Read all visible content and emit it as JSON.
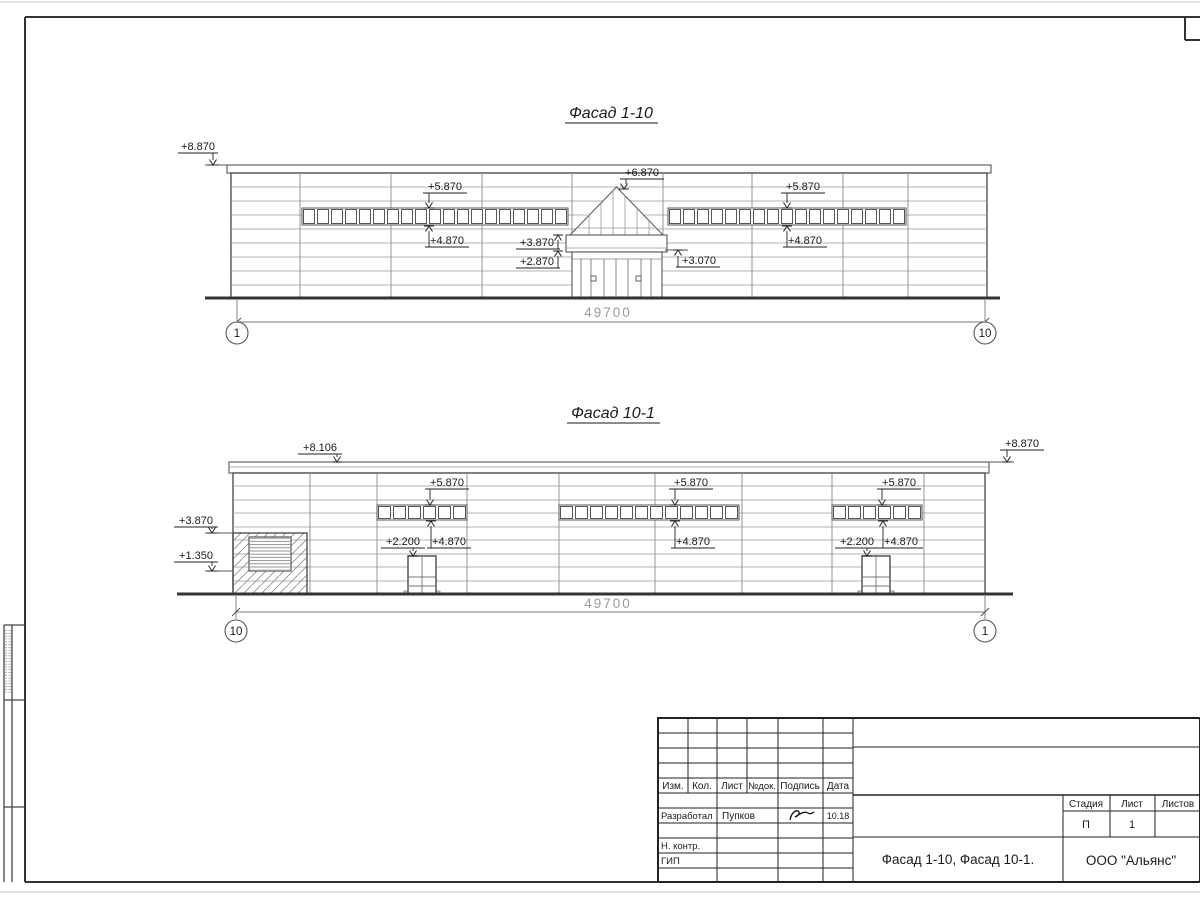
{
  "facades": {
    "top": {
      "title": "Фасад 1-10",
      "dimension": "49700",
      "axis_left": "1",
      "axis_right": "10",
      "marks": {
        "roof_left": "+8.870",
        "strip_left_top": "+5.870",
        "strip_left_bottom": "+4.870",
        "canopy_apex": "+6.870",
        "canopy_top": "+3.870",
        "canopy_bottom": "+2.870",
        "entry_side": "+3.070",
        "strip_right_top": "+5.870",
        "strip_right_bottom": "+4.870"
      }
    },
    "bottom": {
      "title": "Фасад 10-1",
      "dimension": "49700",
      "axis_left": "10",
      "axis_right": "1",
      "marks": {
        "parapet_left": "+8.106",
        "parapet_right": "+8.870",
        "gate_top": "+3.870",
        "gate_mid": "+1.350",
        "strip_a_top": "+5.870",
        "strip_a_bottom": "+4.870",
        "strip_b_top": "+5.870",
        "strip_b_bottom": "+4.870",
        "strip_c_top": "+5.870",
        "strip_c_bottom": "+4.870",
        "door_left": "+2.200",
        "door_right": "+2.200"
      }
    }
  },
  "title_block": {
    "change_headers": [
      "Изм.",
      "Кол.",
      "Лист",
      "№док.",
      "Подпись",
      "Дата"
    ],
    "developed_label": "Разработал",
    "developed_name": "Пупков",
    "developed_date": "10.18",
    "norm_control_label": "Н. контр.",
    "gip_label": "ГИП",
    "doc_title": "Фасад 1-10, Фасад 10-1.",
    "company": "ООО \"Альянс\"",
    "stage_label": "Стадия",
    "sheet_label": "Лист",
    "sheets_label": "Листов",
    "stage_value": "П",
    "sheet_value": "1",
    "sheets_value": ""
  }
}
